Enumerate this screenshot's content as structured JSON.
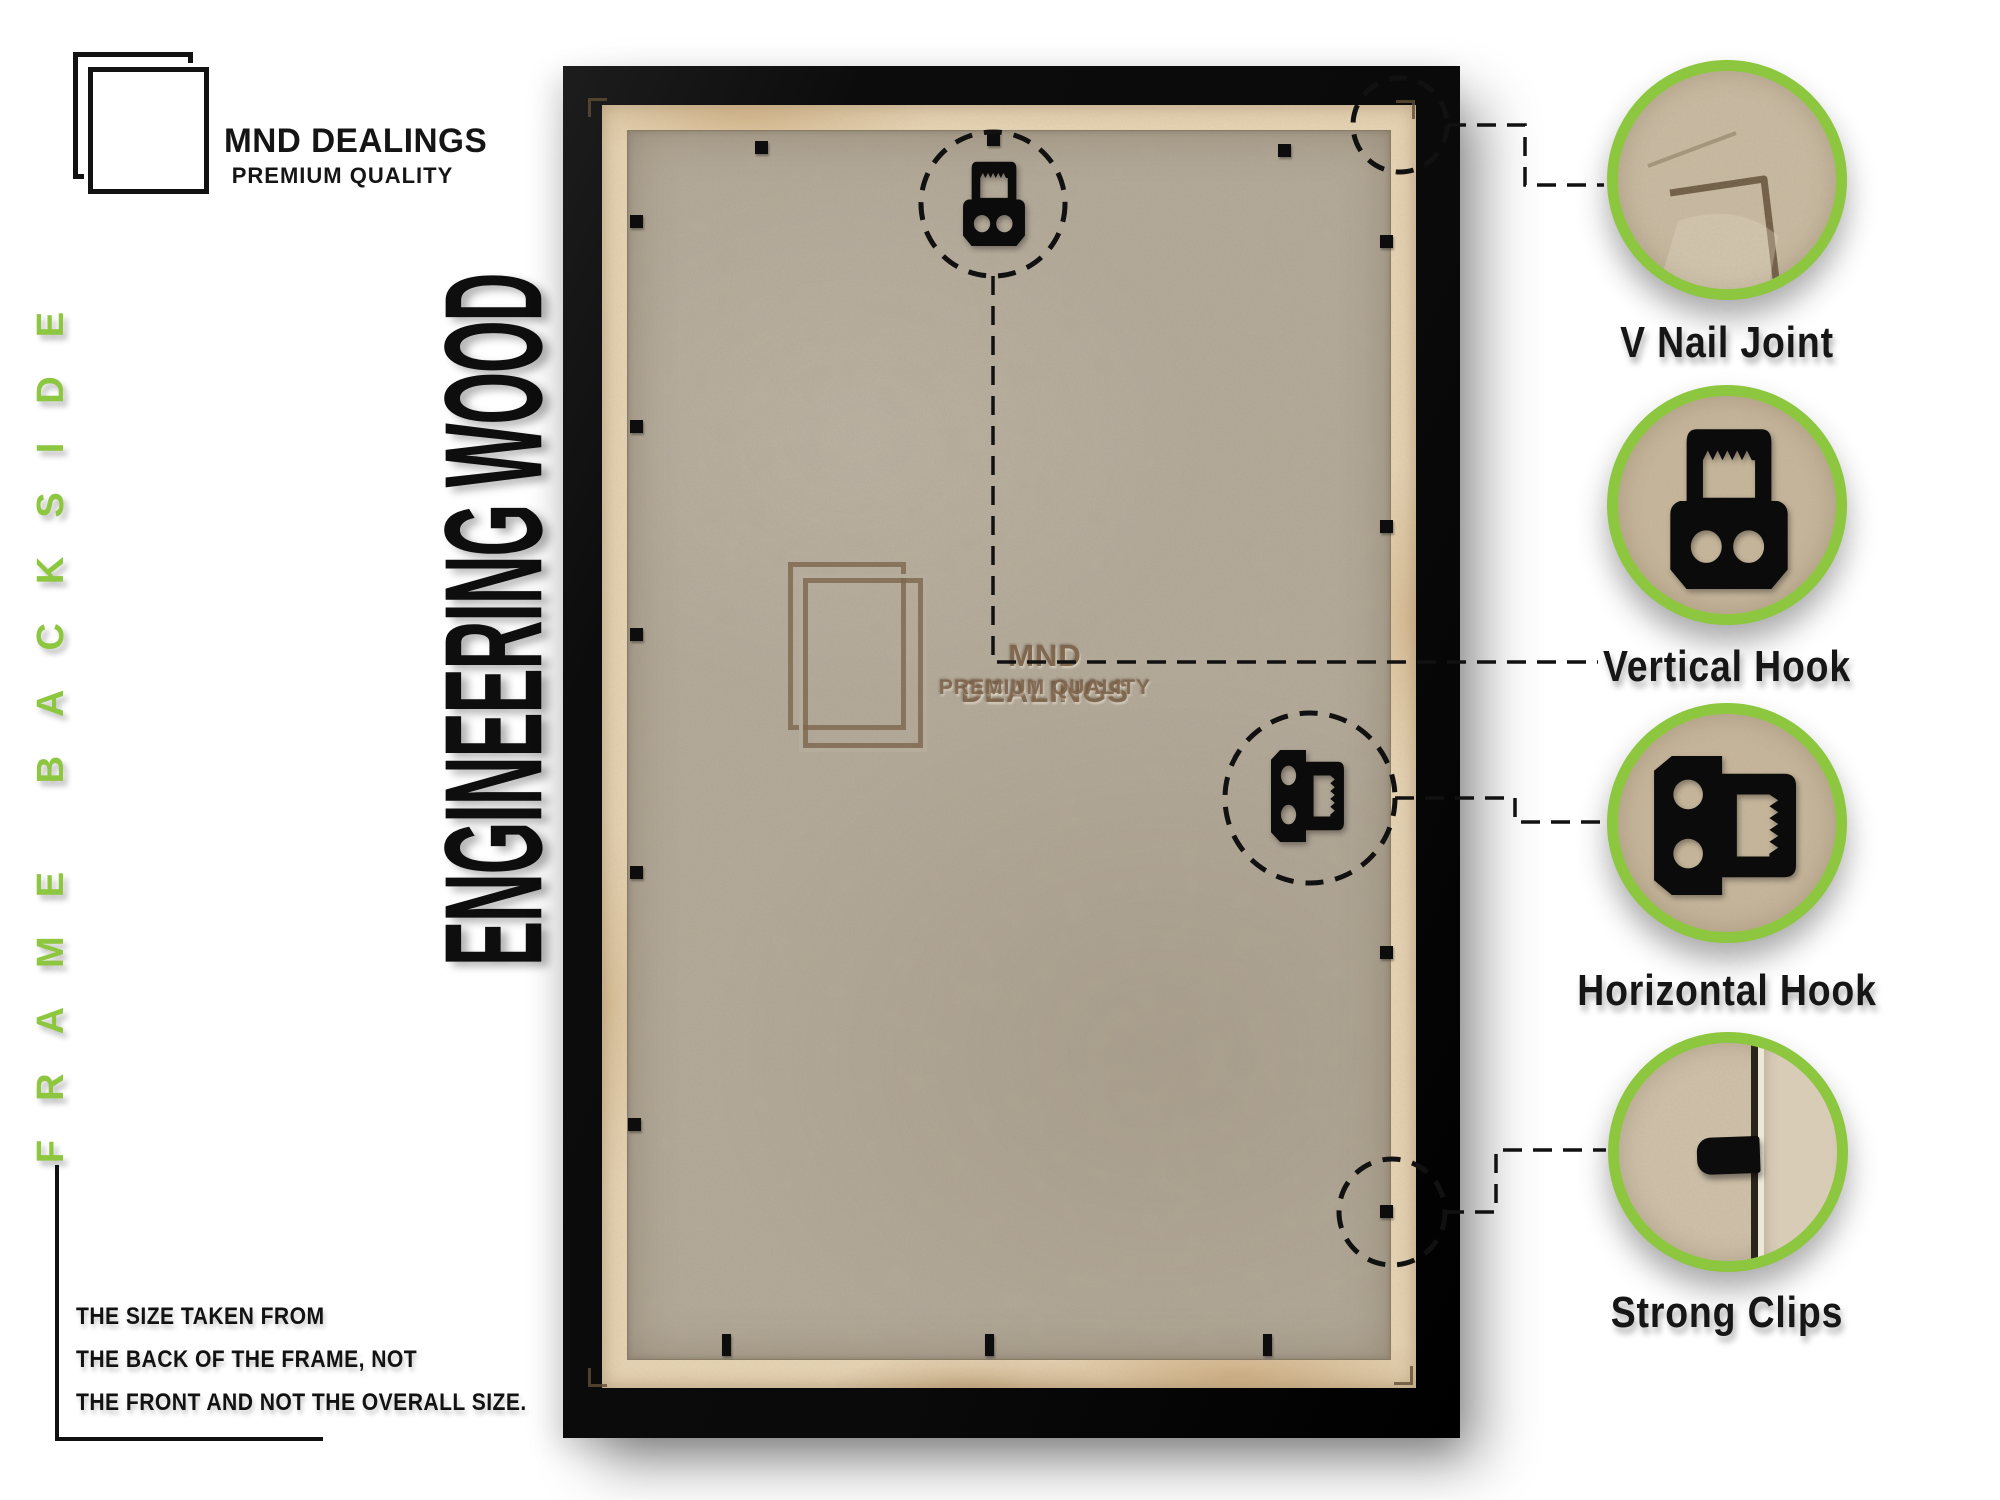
{
  "brand": {
    "name": "MND DEALINGS",
    "tagline": "PREMIUM QUALITY"
  },
  "vertical_labels": {
    "left": "FRAME BACKSIDE",
    "material": "ENGINEERING WOOD"
  },
  "watermark": {
    "name": "MND DEALINGS",
    "tagline": "PREMIUM QUALITY"
  },
  "size_note": {
    "lines": [
      "THE SIZE TAKEN FROM",
      "THE BACK OF THE FRAME, NOT",
      "THE FRONT AND NOT THE OVERALL SIZE."
    ]
  },
  "callouts": [
    {
      "id": "v-nail-joint",
      "label": "V Nail Joint"
    },
    {
      "id": "vertical-hook",
      "label": "Vertical Hook"
    },
    {
      "id": "horizontal-hook",
      "label": "Horizontal Hook"
    },
    {
      "id": "strong-clips",
      "label": "Strong Clips"
    }
  ],
  "colors": {
    "accent_green": "#8dc63f",
    "frame_black": "#0d0d0d",
    "board_tan": "#b6ac9c",
    "lip_tan": "#e6d4b6",
    "watermark_brown": "#8d7a63"
  }
}
